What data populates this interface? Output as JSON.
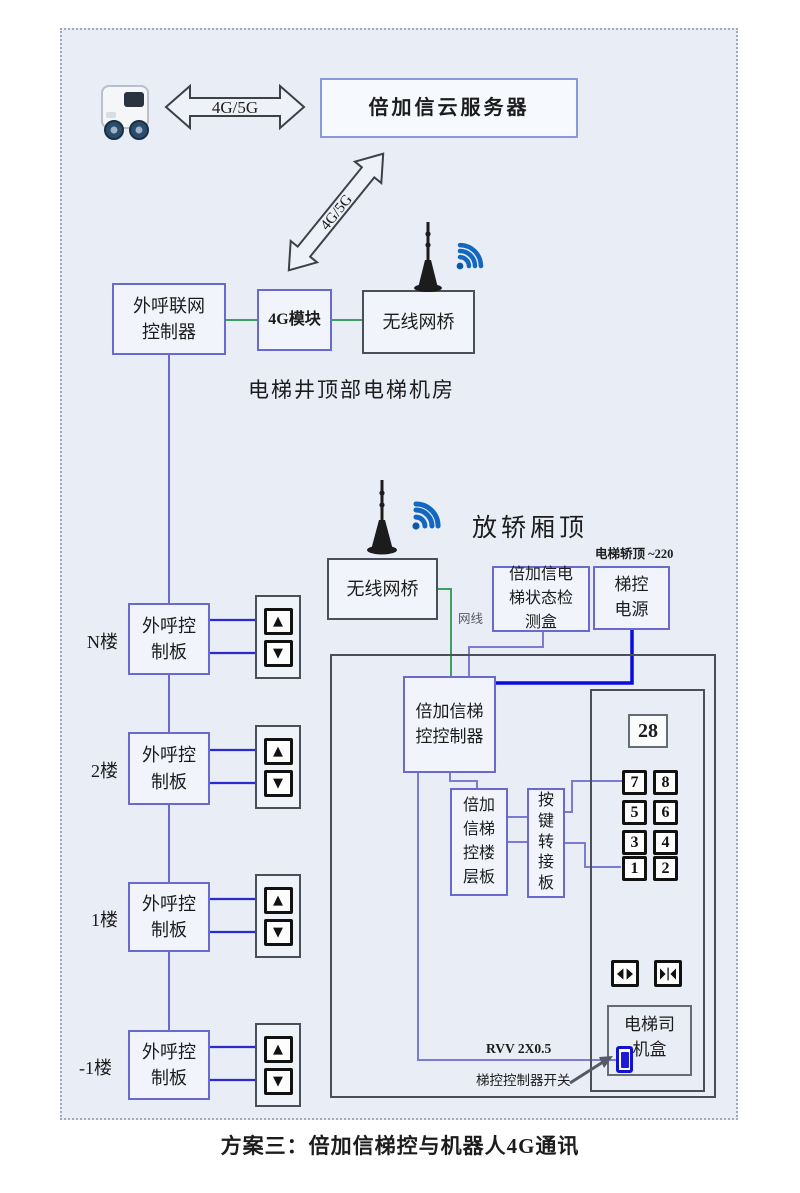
{
  "glyphs": {
    "up": "▲",
    "down": "▼"
  },
  "icons": [
    "delivery-robot-icon",
    "wifi-antenna-icon",
    "door-open-icon",
    "door-close-icon",
    "switch-icon"
  ],
  "top": {
    "link_label": "4G/5G",
    "cloud_server": "倍加信云服务器",
    "diagonal_link_label": "4G/5G"
  },
  "machine_room": {
    "caption": "电梯井顶部电梯机房",
    "network_controller": "外呼联网控制器",
    "module_4g": "4G模块",
    "wireless_bridge": "无线网桥"
  },
  "car_top": {
    "caption": "放轿厢顶",
    "wireless_bridge": "无线网桥",
    "status_box": "倍加信电梯状态检测盒",
    "power_box": "梯控电源",
    "power_note": "电梯轿顶 ~220",
    "cable_label": "网线"
  },
  "floors": [
    {
      "label": "N楼",
      "board": "外呼控制板"
    },
    {
      "label": "2楼",
      "board": "外呼控制板"
    },
    {
      "label": "1楼",
      "board": "外呼控制板"
    },
    {
      "label": "-1楼",
      "board": "外呼控制板"
    }
  ],
  "cabin": {
    "controller": "倍加信梯控控制器",
    "floor_board": "倍加信梯控楼层板",
    "key_adapter": "按键转接板",
    "display_value": "28",
    "keypad": [
      "7",
      "8",
      "5",
      "6",
      "3",
      "4",
      "1",
      "2"
    ],
    "driver_box": "电梯司机盒",
    "wire_label": "RVV 2X0.5",
    "switch_label": "梯控控制器开关"
  },
  "footer": {
    "caption": "方案三：倍加信梯控与机器人4G通讯"
  }
}
